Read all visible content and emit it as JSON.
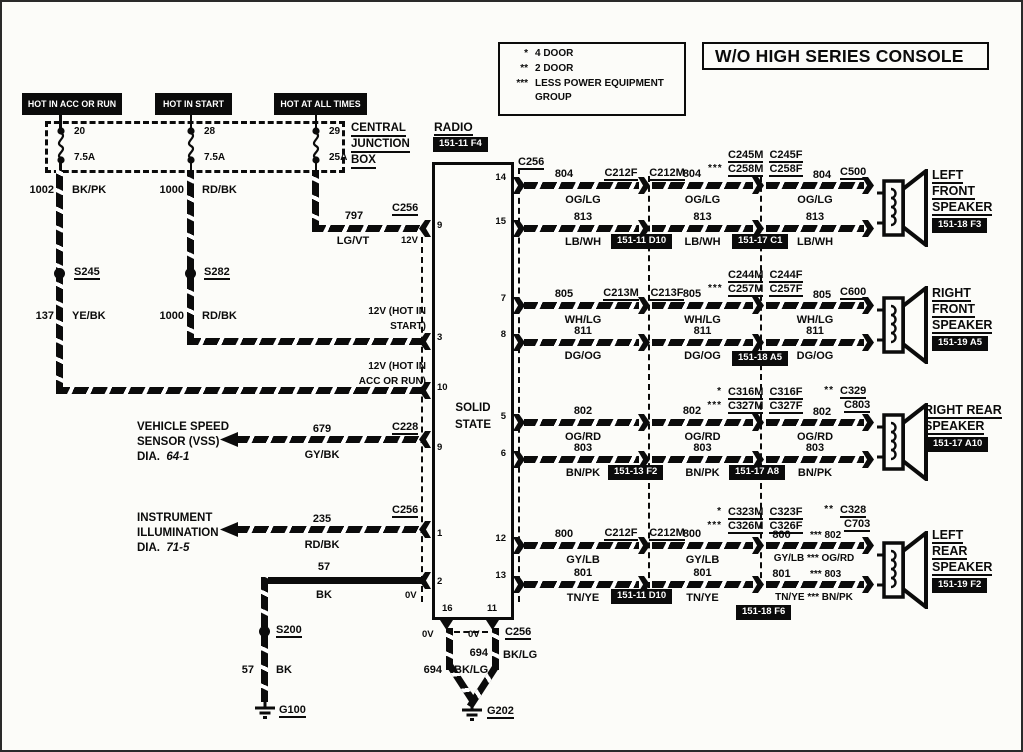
{
  "title": "W/O HIGH SERIES CONSOLE",
  "legend": {
    "rows": [
      {
        "stars": "*",
        "text": "4 DOOR"
      },
      {
        "stars": "**",
        "text": "2 DOOR"
      },
      {
        "stars": "***",
        "text": "LESS POWER EQUIPMENT"
      }
    ],
    "text3b": "GROUP"
  },
  "power_boxes": [
    "HOT IN ACC OR RUN",
    "HOT IN START",
    "HOT AT ALL TIMES"
  ],
  "cjb": {
    "l1": "CENTRAL",
    "l2": "JUNCTION",
    "l3": "BOX",
    "fuses": [
      {
        "pos": "20",
        "amp": "7.5A"
      },
      {
        "pos": "28",
        "amp": "7.5A"
      },
      {
        "pos": "29",
        "amp": "25A"
      }
    ]
  },
  "feeds": {
    "w1002_num": "1002",
    "w1002_color": "BK/PK",
    "s245": "S245",
    "w137_num": "137",
    "w137_color": "YE/BK",
    "w1000_num": "1000",
    "w1000_color": "RD/BK",
    "s282": "S282",
    "w1000b_num": "1000",
    "w1000b_color": "RD/BK",
    "w797_num": "797",
    "w797_color": "LG/VT",
    "c256": "C256",
    "v12": "12V",
    "start_l1": "12V (HOT IN",
    "start_l2": "START)",
    "acc_l1": "12V (HOT IN",
    "acc_l2": "ACC OR RUN)"
  },
  "radio": {
    "name": "RADIO",
    "badge": "151-11 F4",
    "body1": "SOLID",
    "body2": "STATE",
    "pins_left": [
      "9",
      "3",
      "10",
      "9",
      "1",
      "2"
    ],
    "pins_right": [
      "14",
      "15",
      "7",
      "8",
      "5",
      "6",
      "12",
      "13"
    ],
    "pin_bl": "16",
    "pin_br": "11"
  },
  "vss": {
    "l1": "VEHICLE SPEED",
    "l2": "SENSOR (VSS)",
    "dia": "DIA.",
    "dia_num": "64-1",
    "num": "679",
    "color": "GY/BK",
    "conn": "C228"
  },
  "illum": {
    "l1": "INSTRUMENT",
    "l2": "ILLUMINATION",
    "dia": "DIA.",
    "dia_num": "71-5",
    "num": "235",
    "color": "RD/BK",
    "conn": "C256"
  },
  "gnd57": {
    "num": "57",
    "color": "BK",
    "v0": "0V",
    "splice": "S200",
    "num2": "57",
    "color2": "BK",
    "ground": "G100"
  },
  "gnd694": {
    "v0a": "0V",
    "v0b": "0V",
    "conn": "C256",
    "numR": "694",
    "colorR": "BK/LG",
    "numL": "694",
    "colorL": "BK/LG",
    "ground": "G202"
  },
  "rows": [
    {
      "plane": "C256",
      "j1a": "C212F",
      "j1b": "C212M",
      "badge1": "151-11 D10",
      "badge2": "151-17 C1",
      "seg1": {
        "tn": "804",
        "tc": "OG/LG",
        "bn": "813",
        "bc": "LB/WH"
      },
      "seg2": {
        "stars": "***",
        "tn": "804",
        "tc": "OG/LG",
        "bn": "813",
        "bc": "LB/WH",
        "c1s": "",
        "c1a": "C245M",
        "c1b": "C245F",
        "c2s": "",
        "c2a": "C258M",
        "c2b": "C258F"
      },
      "seg3": {
        "tn": "804",
        "end1": "C500",
        "tc": "OG/LG",
        "bn": "813",
        "bc": "LB/WH"
      },
      "speaker": {
        "l1": "LEFT",
        "l2": "FRONT",
        "l3": "SPEAKER",
        "badge": "151-18 F3"
      }
    },
    {
      "j1a": "C213M",
      "j1b": "C213F",
      "badge2": "151-18 A5",
      "seg1": {
        "tn": "805",
        "tc": "WH/LG",
        "bn": "811",
        "bc": "DG/OG"
      },
      "seg2": {
        "stars": "***",
        "tn": "805",
        "tc": "WH/LG",
        "bn": "811",
        "bc": "DG/OG",
        "c1s": "",
        "c1a": "C244M",
        "c1b": "C244F",
        "c2s": "",
        "c2a": "C257M",
        "c2b": "C257F"
      },
      "seg3": {
        "tn": "805",
        "end1": "C600",
        "tc": "WH/LG",
        "bn": "811",
        "bc": "DG/OG"
      },
      "speaker": {
        "l1": "RIGHT",
        "l2": "FRONT",
        "l3": "SPEAKER",
        "badge": "151-19 A5"
      }
    },
    {
      "badge1": "151-13 F2",
      "badge2": "151-17 A8",
      "seg1": {
        "tn": "802",
        "tc": "OG/RD",
        "bn": "803",
        "bc": "BN/PK"
      },
      "seg2": {
        "tn": "802",
        "tc": "OG/RD",
        "bn": "803",
        "bc": "BN/PK",
        "c1s": "*",
        "c1a": "C316M",
        "c1b": "C316F",
        "c2s": "***",
        "c2a": "C327M",
        "c2b": "C327F"
      },
      "seg3": {
        "tn": "802",
        "ends": "**",
        "end1": "C329",
        "end2": "C803",
        "tc": "OG/RD",
        "bn": "803",
        "bc": "BN/PK"
      },
      "speaker": {
        "l1": "RIGHT REAR",
        "l2": "SPEAKER",
        "badge": "151-17 A10"
      }
    },
    {
      "j1a": "C212F",
      "j1b": "C212M",
      "badge1": "151-11 D10",
      "badge2": "151-18 F6",
      "seg1": {
        "tn": "800",
        "tc": "GY/LB",
        "bn": "801",
        "bc": "TN/YE"
      },
      "seg2": {
        "tn": "800",
        "tc": "GY/LB",
        "bn": "801",
        "bc": "TN/YE",
        "c1s": "*",
        "c1a": "C323M",
        "c1b": "C323F",
        "c2s": "***",
        "c2a": "C326M",
        "c2b": "C326F"
      },
      "seg3": {
        "tn": "800",
        "tnr": "*** 802",
        "ends": "**",
        "end1": "C328",
        "end2": "C703",
        "tc": "GY/LB *** OG/RD",
        "bn": "801",
        "bnr": "*** 803",
        "bc": "TN/YE *** BN/PK"
      },
      "speaker": {
        "l1": "LEFT",
        "l2": "REAR",
        "l3": "SPEAKER",
        "badge": "151-19 F2"
      }
    }
  ]
}
